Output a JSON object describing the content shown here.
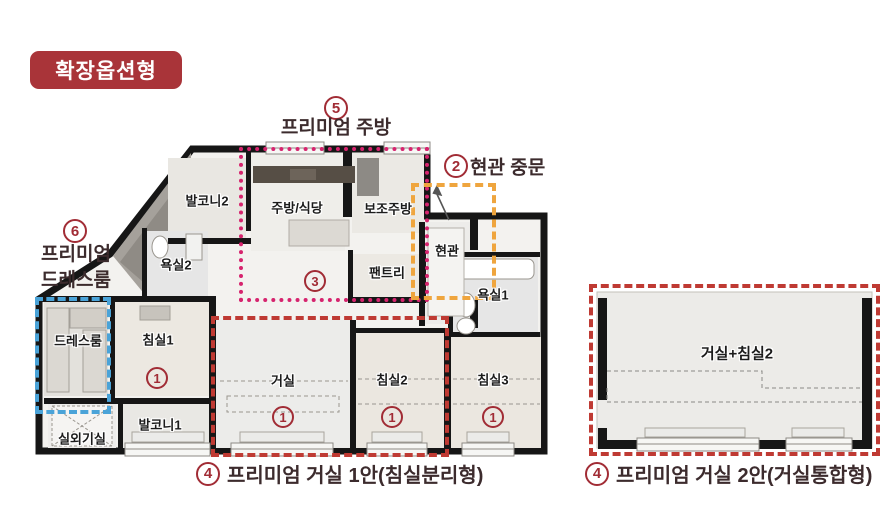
{
  "badge_label": "확장옵션형",
  "colors": {
    "badge_bg": "#a93439",
    "marker_red": "#a12c35",
    "premium_kitchen_outline": "#d6246e",
    "entrance_door_outline": "#efa53e",
    "premium_dressroom_outline": "#4aa3d8",
    "premium_living_outline": "#bf3a33",
    "annotation_text": "#3c2b2d",
    "wall": "#161616",
    "floor": "#f3f2ef"
  },
  "rooms": {
    "balcony2": "발코니2",
    "kitchen_dining": "주방/식당",
    "aux_kitchen": "보조주방",
    "entrance": "현관",
    "bath2": "욕실2",
    "pantry": "팬트리",
    "bath1": "욕실1",
    "dress_room": "드레스룸",
    "bedroom1": "침실1",
    "living": "거실",
    "bedroom2": "침실2",
    "bedroom3": "침실3",
    "balcony1": "발코니1",
    "outdoor_unit": "실외기실",
    "living_bedroom2": "거실+침실2"
  },
  "markers": {
    "hall": "3",
    "bedroom1": "1",
    "living": "1",
    "bedroom2": "1",
    "bedroom3": "1"
  },
  "annotations": {
    "premium_kitchen": {
      "num": "5",
      "label": "프리미엄 주방"
    },
    "entrance_door": {
      "num": "2",
      "label": "현관 중문"
    },
    "premium_dressroom": {
      "num": "6",
      "label_line1": "프리미엄",
      "label_line2": "드레스룸"
    },
    "living_option1": {
      "num": "4",
      "label": "프리미엄 거실 1안(침실분리형)"
    },
    "living_option2": {
      "num": "4",
      "label": "프리미엄 거실 2안(거실통합형)"
    }
  }
}
